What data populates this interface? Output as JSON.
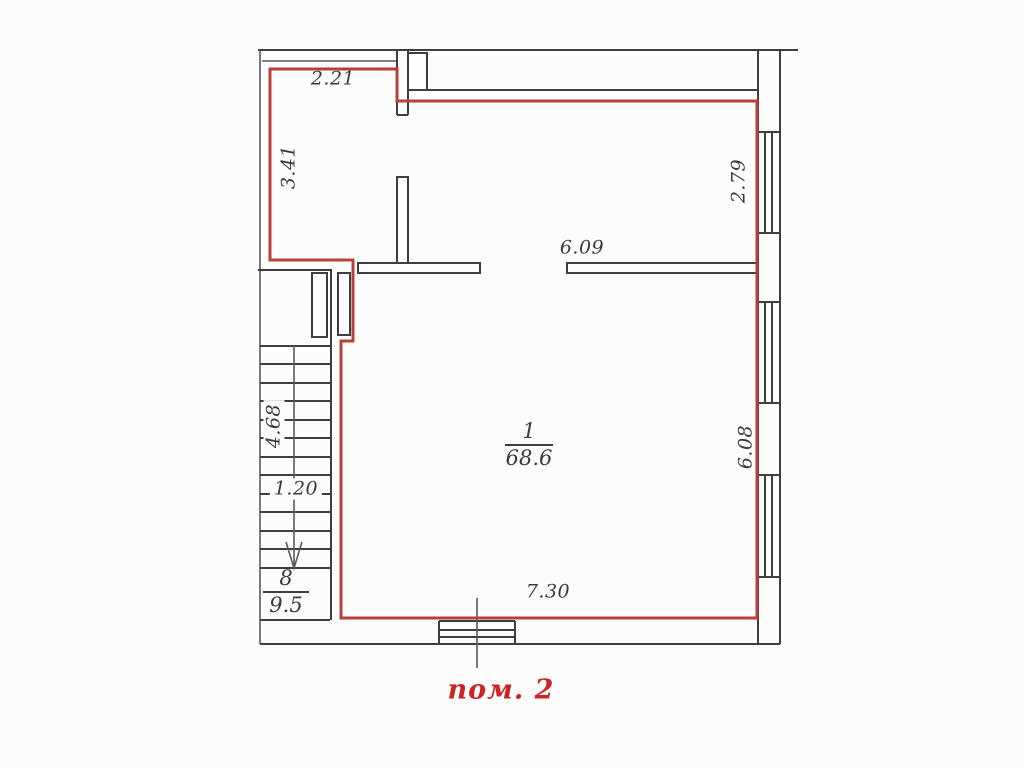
{
  "plan": {
    "caption": "пом. 2",
    "rooms": {
      "main": {
        "number": "1",
        "area": "68.6"
      },
      "stairs": {
        "number": "8",
        "area": "9.5"
      }
    },
    "dimensions": {
      "top_offset": "2.21",
      "left_upper": "3.41",
      "right_upper": "2.79",
      "interior_wall": "6.09",
      "right_lower": "6.08",
      "stair_run": "4.68",
      "stair_width": "1.20",
      "bottom": "7.30"
    },
    "colors": {
      "room_outline": "#b8403c",
      "walls": "#3e3e3e",
      "caption": "#cc2424",
      "background": "#fcfcfc"
    }
  }
}
